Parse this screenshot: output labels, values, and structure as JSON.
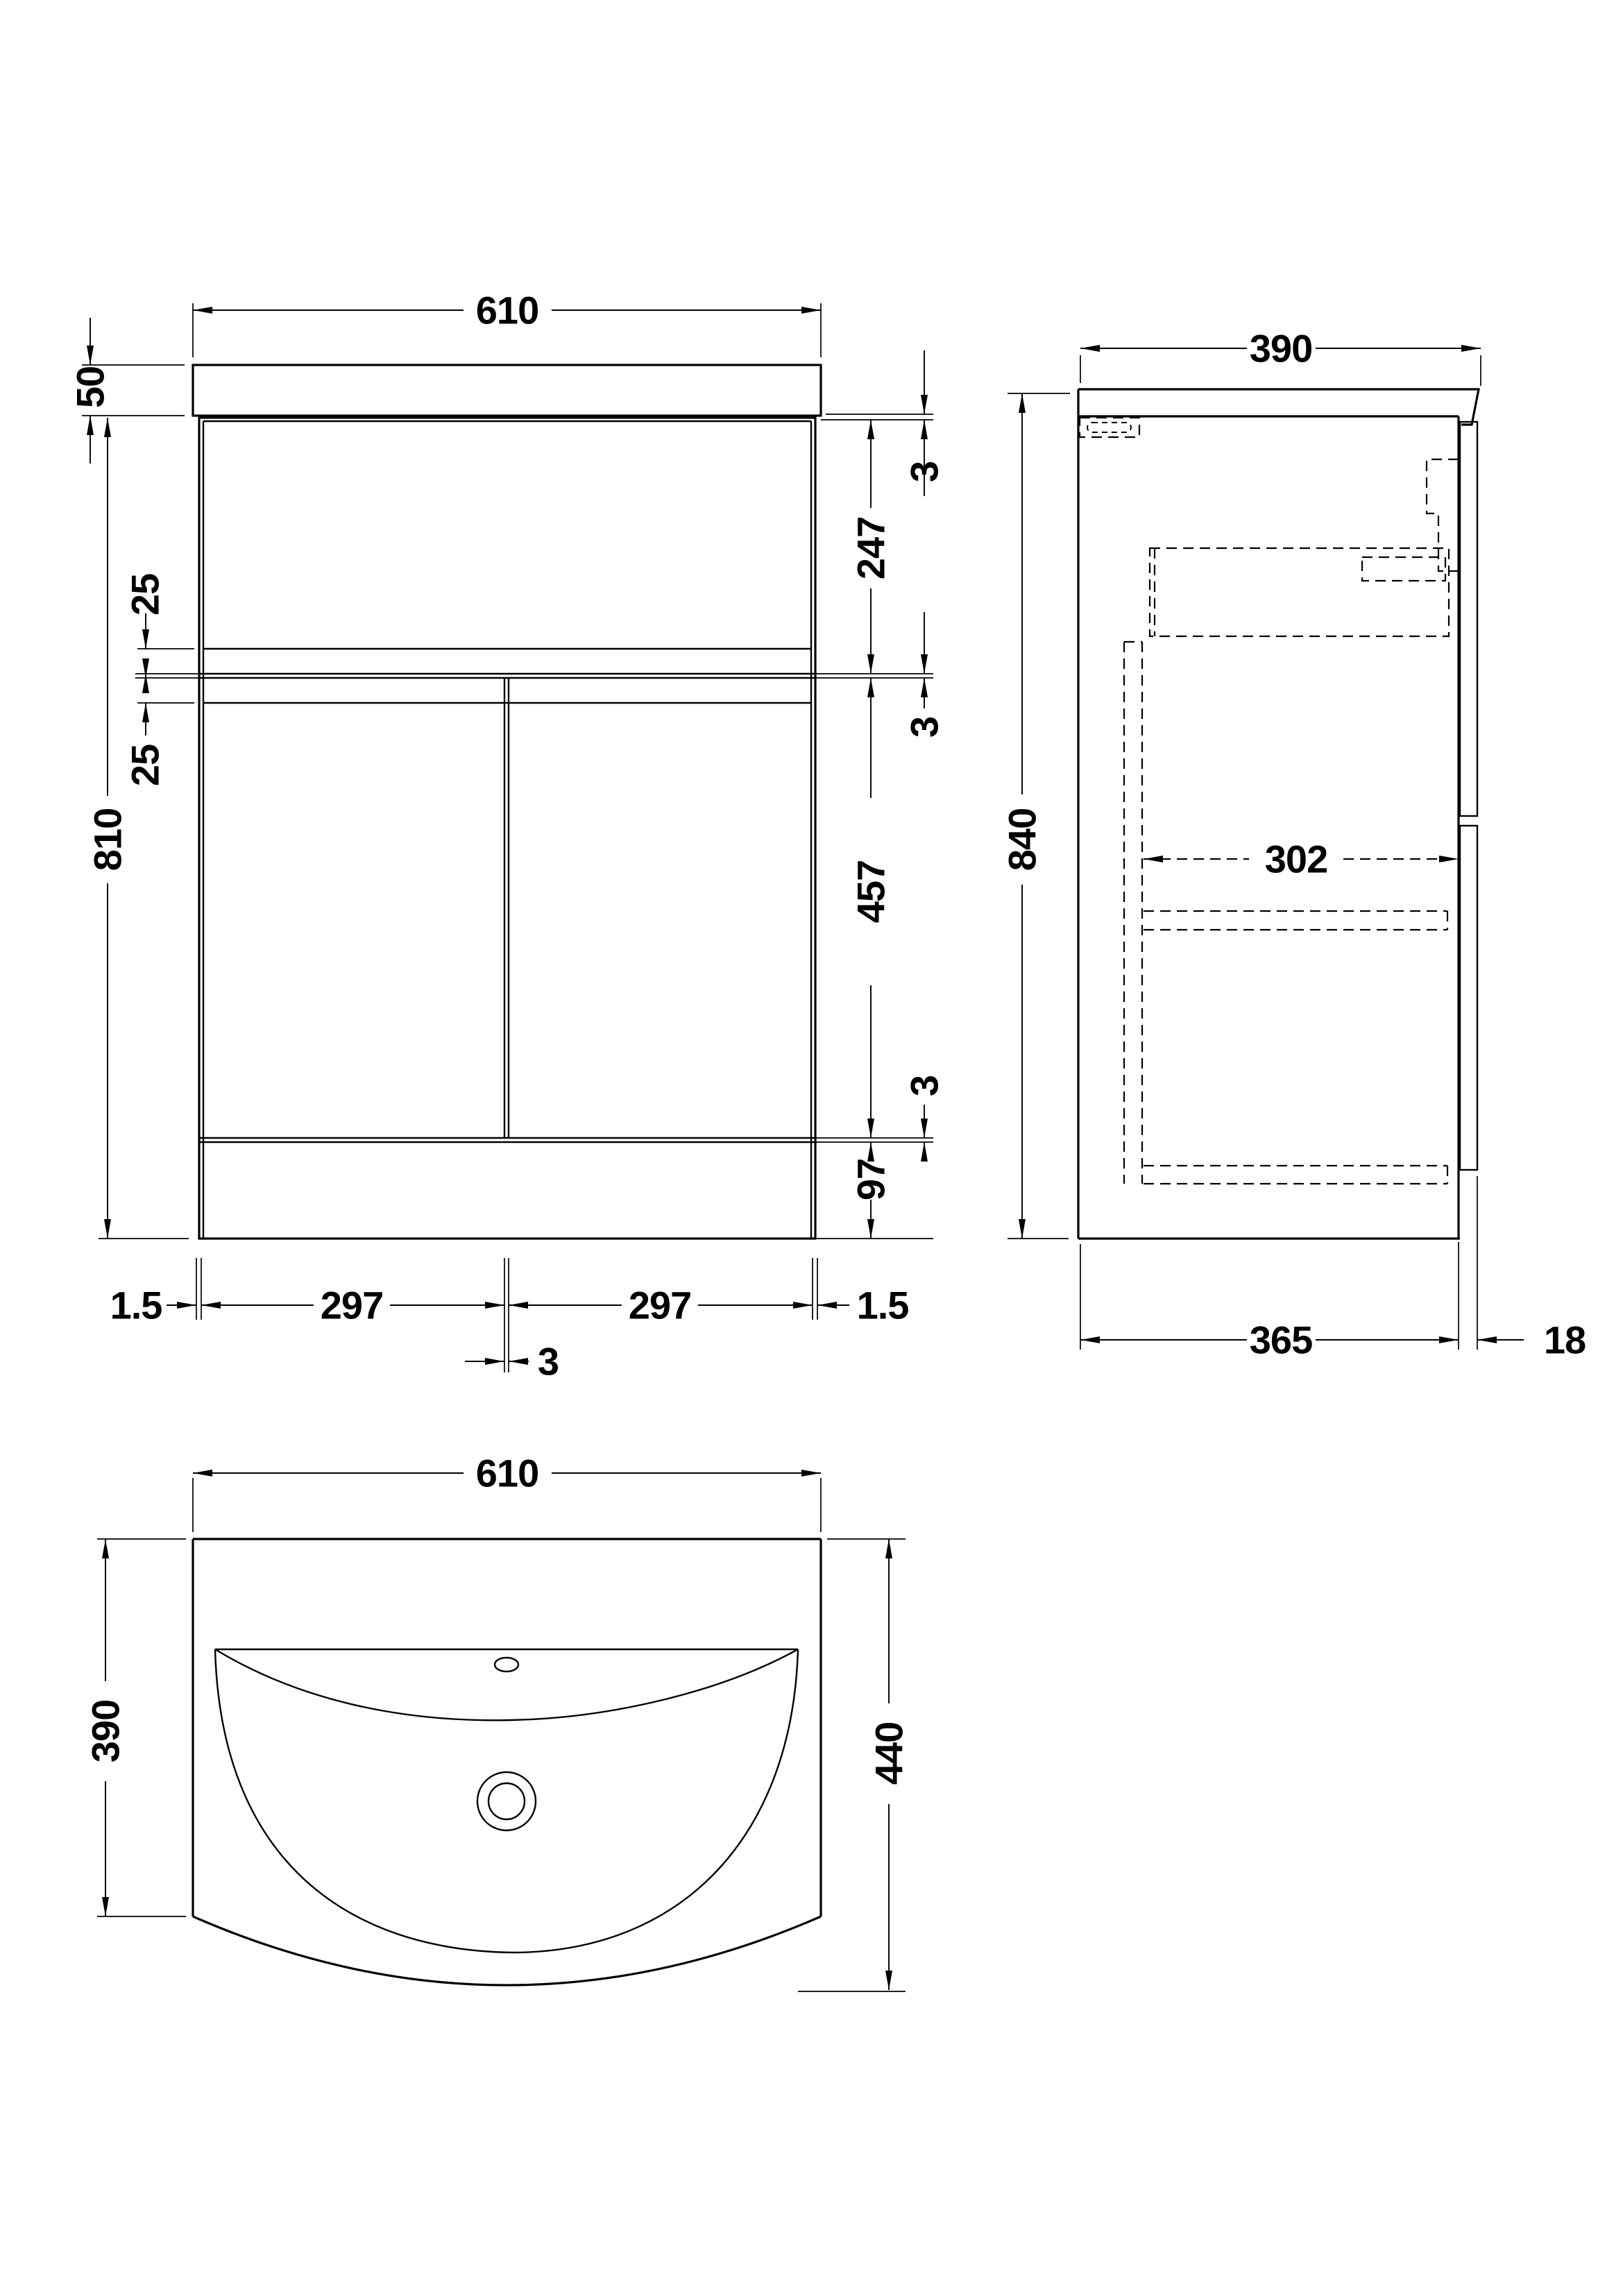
{
  "colors": {
    "ink": "#000000",
    "paper": "#ffffff"
  },
  "front_view": {
    "width": "610",
    "worktop_height": "50",
    "overall_height": "810",
    "recess_upper": "25",
    "recess_lower": "25",
    "top_gap": "3",
    "drawer_height": "247",
    "mid_gap": "3",
    "door_height": "457",
    "bottom_gap": "3",
    "plinth_height": "97",
    "left_margin": "1.5",
    "left_door_width": "297",
    "right_door_width": "297",
    "right_margin": "1.5",
    "door_gap": "3"
  },
  "side_view": {
    "depth": "390",
    "overall_height": "840",
    "internal_width": "302",
    "carcass_depth": "365",
    "door_thickness": "18"
  },
  "plan_view": {
    "width": "610",
    "basin_depth": "390",
    "overall_depth": "440"
  }
}
